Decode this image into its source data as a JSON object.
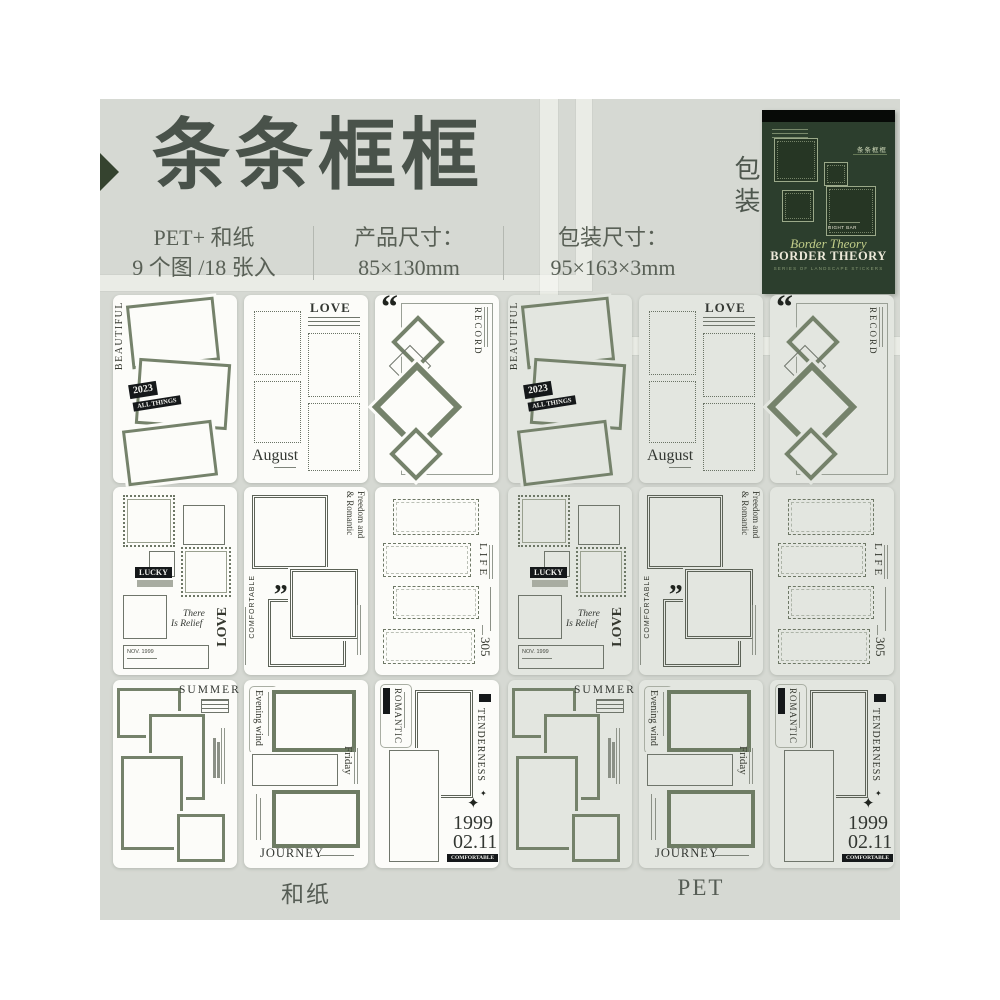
{
  "header": {
    "title": "条条框框",
    "specs": [
      {
        "line1": "PET+ 和纸",
        "line2": "9 个图 /18 张入"
      },
      {
        "line1": "产品尺寸：",
        "line2": "85×130mm"
      },
      {
        "line1": "包装尺寸：",
        "line2": "95×163×3mm"
      }
    ]
  },
  "package": {
    "side_label": "包装",
    "cn_title": "条条框框",
    "small_label": "RIGHT BAR",
    "script_title": "Border Theory",
    "title": "BORDER THEORY",
    "subtitle": "SERIES OF LANDSCAPE STICKERS"
  },
  "groups": [
    {
      "label": "和纸",
      "type": "washi"
    },
    {
      "label": "PET",
      "type": "pet"
    }
  ],
  "colors": {
    "accent_green": "#35432f",
    "sage_frame": "#75826b",
    "canvas": "#d6d9d3",
    "package_green": "#2c3e2d"
  },
  "designs": [
    {
      "id": "beautiful",
      "texts": {
        "side": "BEAUTIFUL",
        "year": "2023",
        "all": "ALL THINGS"
      }
    },
    {
      "id": "august",
      "texts": {
        "love": "LOVE",
        "month": "August"
      }
    },
    {
      "id": "record",
      "texts": {
        "quote": "“",
        "title": "RECORD"
      }
    },
    {
      "id": "lucky",
      "texts": {
        "lucky": "LUCKY",
        "relief1": "There",
        "relief2": "Is Relief",
        "love": "LOVE",
        "date": "NOV. 1999"
      }
    },
    {
      "id": "freedom",
      "texts": {
        "line1": "Freedom and",
        "line2": "& Romantic",
        "comfort": "COMFORTABLE",
        "quote": "„"
      }
    },
    {
      "id": "life",
      "texts": {
        "title": "LIFE",
        "num": "305"
      }
    },
    {
      "id": "summer",
      "texts": {
        "title": "SUMMER"
      }
    },
    {
      "id": "evening",
      "texts": {
        "vert": "Evening wind",
        "friday": "Friday",
        "journey": "JOURNEY"
      }
    },
    {
      "id": "romantic",
      "texts": {
        "rom": "ROMANTIC",
        "tend": "TENDERNESS",
        "sparkle": "✦",
        "sparkle2": "✦",
        "year": "1999",
        "date": "02.11",
        "comfort": "COMFORTABLE"
      }
    }
  ]
}
